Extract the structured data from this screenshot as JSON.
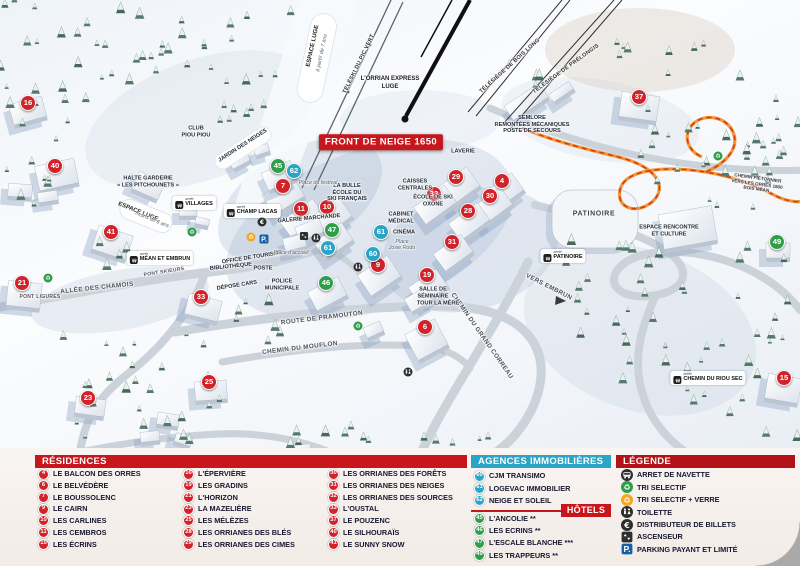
{
  "colors": {
    "red": "#c8161d",
    "darkred": "#b31218",
    "marker_red": "#d2232a",
    "green": "#2f9e49",
    "blue": "#2ba4c6",
    "parking_blue": "#1660a8",
    "path_orange": "#f08c1e"
  },
  "map": {
    "banner": "FRONT DE NEIGE 1650",
    "markers": [
      {
        "n": "16",
        "type": "res",
        "x": 28,
        "y": 103
      },
      {
        "n": "40",
        "type": "res",
        "x": 55,
        "y": 166
      },
      {
        "n": "41",
        "type": "res",
        "x": 111,
        "y": 232
      },
      {
        "n": "21",
        "type": "res",
        "x": 22,
        "y": 283
      },
      {
        "n": "33",
        "type": "res",
        "x": 201,
        "y": 297
      },
      {
        "n": "23",
        "type": "res",
        "x": 88,
        "y": 398
      },
      {
        "n": "25",
        "type": "res",
        "x": 209,
        "y": 382
      },
      {
        "n": "7",
        "type": "res",
        "x": 283,
        "y": 186
      },
      {
        "n": "11",
        "type": "res",
        "x": 301,
        "y": 209
      },
      {
        "n": "10",
        "type": "res",
        "x": 327,
        "y": 207
      },
      {
        "n": "9",
        "type": "res",
        "x": 378,
        "y": 265
      },
      {
        "n": "19",
        "type": "res",
        "x": 427,
        "y": 275
      },
      {
        "n": "6",
        "type": "res",
        "x": 425,
        "y": 327
      },
      {
        "n": "29",
        "type": "res",
        "x": 456,
        "y": 177
      },
      {
        "n": "4",
        "type": "res",
        "x": 502,
        "y": 181
      },
      {
        "n": "32",
        "type": "res",
        "x": 434,
        "y": 194
      },
      {
        "n": "30",
        "type": "res",
        "x": 490,
        "y": 196
      },
      {
        "n": "28",
        "type": "res",
        "x": 468,
        "y": 211
      },
      {
        "n": "31",
        "type": "res",
        "x": 452,
        "y": 242
      },
      {
        "n": "37",
        "type": "res",
        "x": 639,
        "y": 97
      },
      {
        "n": "15",
        "type": "res",
        "x": 784,
        "y": 378
      },
      {
        "n": "45",
        "type": "hotel",
        "x": 278,
        "y": 166
      },
      {
        "n": "47",
        "type": "hotel",
        "x": 332,
        "y": 230
      },
      {
        "n": "46",
        "type": "hotel",
        "x": 326,
        "y": 283
      },
      {
        "n": "49",
        "type": "hotel",
        "x": 777,
        "y": 242
      },
      {
        "n": "62",
        "type": "agence",
        "x": 294,
        "y": 171
      },
      {
        "n": "61",
        "type": "agence",
        "x": 328,
        "y": 248
      },
      {
        "n": "61",
        "type": "agence",
        "x": 381,
        "y": 232
      },
      {
        "n": "60",
        "type": "agence",
        "x": 373,
        "y": 254
      }
    ],
    "labels": [
      {
        "text": "L'ORRIAN EXPRESS",
        "x": 390,
        "y": 79,
        "rot": 0,
        "cls": "dk"
      },
      {
        "text": "LUGE",
        "x": 390,
        "y": 87,
        "rot": 0,
        "cls": "dk"
      },
      {
        "text": "ESPACE LUGE",
        "x": 313,
        "y": 46,
        "rot": -78,
        "cls": "dk"
      },
      {
        "text": "à partir de 7 ans",
        "x": 322,
        "y": 53,
        "rot": -78,
        "cls": "it"
      },
      {
        "text": "TÉLÉSKI DU PIC VERT",
        "x": 359,
        "y": 64,
        "rot": -64,
        "cls": "lift"
      },
      {
        "text": "TÉLÉSIÈGE DE BOIS LONG",
        "x": 510,
        "y": 66,
        "rot": -42,
        "cls": "lift"
      },
      {
        "text": "TÉLÉSIÈGE DE PRÉLONGIS",
        "x": 566,
        "y": 69,
        "rot": -36,
        "cls": "lift"
      },
      {
        "lines": [
          "SEMLORE",
          "REMONTÉES MÉCANIQUES",
          "POSTE DE SECOURS"
        ],
        "x": 532,
        "y": 125,
        "rot": 0,
        "cls": "bld"
      },
      {
        "text": "LAVERIE",
        "x": 463,
        "y": 152,
        "rot": 0,
        "cls": "bld"
      },
      {
        "lines": [
          "CAISSES",
          "CENTRALES"
        ],
        "x": 415,
        "y": 185,
        "rot": 0,
        "cls": "bld"
      },
      {
        "lines": [
          "LA BULLE",
          "ÉCOLE DU",
          "SKI FRANÇAIS"
        ],
        "x": 347,
        "y": 193,
        "rot": 0,
        "cls": "bld"
      },
      {
        "text": "Place du festival",
        "x": 318,
        "y": 183,
        "rot": 0,
        "cls": "it"
      },
      {
        "text": "GALERIE MARCHANDE",
        "x": 309,
        "y": 219,
        "rot": -5,
        "cls": "bld"
      },
      {
        "lines": [
          "ÉCOLE DE SKI",
          "OXONE"
        ],
        "x": 433,
        "y": 201,
        "rot": 0,
        "cls": "bld"
      },
      {
        "lines": [
          "CABINET",
          "MÉDICAL"
        ],
        "x": 401,
        "y": 218,
        "rot": 0,
        "cls": "bld"
      },
      {
        "text": "CINÉMA",
        "x": 404,
        "y": 233,
        "rot": 0,
        "cls": "bld"
      },
      {
        "lines": [
          "Place",
          "Josie Rodo"
        ],
        "x": 402,
        "y": 245,
        "rot": 0,
        "cls": "it"
      },
      {
        "lines": [
          "CLUB",
          "PIOU PIOU"
        ],
        "x": 196,
        "y": 132,
        "rot": 0,
        "cls": "bld"
      },
      {
        "text": "JARDIN DES NEIGES",
        "x": 243,
        "y": 146,
        "rot": -33,
        "cls": "bld"
      },
      {
        "lines": [
          "HALTE GARDERIE",
          "« LES PITCHOUNETS »"
        ],
        "x": 148,
        "y": 182,
        "rot": 0,
        "cls": "bld"
      },
      {
        "text": "ESPACE LUGE",
        "x": 138,
        "y": 212,
        "rot": 22,
        "cls": "dk"
      },
      {
        "text": "moins de 6 ans",
        "x": 152,
        "y": 220,
        "rot": 22,
        "cls": "it"
      },
      {
        "text": "PATINOIRE",
        "x": 594,
        "y": 214,
        "rot": 0,
        "cls": "bldlg"
      },
      {
        "lines": [
          "ESPACE RENCONTRE",
          "ET CULTURE"
        ],
        "x": 669,
        "y": 231,
        "rot": 0,
        "cls": "bld"
      },
      {
        "text": "VERS EMBRUN",
        "x": 549,
        "y": 287,
        "rot": 27,
        "cls": "road"
      },
      {
        "text": "ALLÉE DES CHAMOIS",
        "x": 97,
        "y": 288,
        "rot": -6,
        "cls": "road"
      },
      {
        "text": "PONT LIGURES",
        "x": 40,
        "y": 297,
        "rot": 0,
        "cls": "roadsm"
      },
      {
        "text": "PONT SKIEURS",
        "x": 164,
        "y": 272,
        "rot": -9,
        "cls": "roadsm"
      },
      {
        "text": "BIBLIOTHÈQUE",
        "x": 231,
        "y": 267,
        "rot": -6,
        "cls": "bld"
      },
      {
        "text": "OFFICE DE TOURISME",
        "x": 252,
        "y": 258,
        "rot": -9,
        "cls": "bld"
      },
      {
        "text": "POSTE",
        "x": 263,
        "y": 269,
        "rot": 0,
        "cls": "bld"
      },
      {
        "text": "DÉPOSE CARS",
        "x": 237,
        "y": 286,
        "rot": -9,
        "cls": "bld"
      },
      {
        "lines": [
          "POLICE",
          "MUNICIPALE"
        ],
        "x": 282,
        "y": 285,
        "rot": 0,
        "cls": "bld"
      },
      {
        "text": "Place d'accueil",
        "x": 291,
        "y": 253,
        "rot": 0,
        "cls": "it"
      },
      {
        "text": "ROUTE DE PRAMOUTON",
        "x": 322,
        "y": 318,
        "rot": -7,
        "cls": "road"
      },
      {
        "text": "CHEMIN DU MOUFLON",
        "x": 300,
        "y": 348,
        "rot": -7,
        "cls": "road"
      },
      {
        "text": "CHEMIN DU GRAND CORREAU",
        "x": 482,
        "y": 336,
        "rot": 55,
        "cls": "road"
      },
      {
        "lines": [
          "SALLE DE",
          "SÉMINAIRE"
        ],
        "x": 433,
        "y": 293,
        "rot": 0,
        "cls": "bld"
      },
      {
        "text": "TOUR LA MÈRE",
        "x": 438,
        "y": 304,
        "rot": 0,
        "cls": "bld"
      },
      {
        "lines": [
          "CHEMIN PIÉTONNIER",
          "VERS LES ORRES 1800",
          "BOIS MÉAN"
        ],
        "x": 757,
        "y": 184,
        "rot": 8,
        "cls": "tiny"
      }
    ],
    "stops": [
      {
        "label": "VILLAGES",
        "x": 194,
        "y": 203
      },
      {
        "label": "CHAMP LACAS",
        "x": 252,
        "y": 211
      },
      {
        "label": "MÉAN ET EMBRUN",
        "x": 160,
        "y": 258
      },
      {
        "label": "PATINOIRE",
        "x": 563,
        "y": 256
      },
      {
        "label": "CHEMIN DU RIOU SEC",
        "x": 708,
        "y": 378
      }
    ],
    "icons": [
      {
        "t": "recycle-green",
        "x": 48,
        "y": 278
      },
      {
        "t": "recycle-green",
        "x": 192,
        "y": 232
      },
      {
        "t": "recycle-green",
        "x": 358,
        "y": 326
      },
      {
        "t": "recycle-green",
        "x": 718,
        "y": 156
      },
      {
        "t": "recycle-orange",
        "x": 251,
        "y": 237
      },
      {
        "t": "parking",
        "x": 264,
        "y": 239
      },
      {
        "t": "elevator",
        "x": 304,
        "y": 236
      },
      {
        "t": "toilet",
        "x": 316,
        "y": 238
      },
      {
        "t": "toilet",
        "x": 358,
        "y": 267
      },
      {
        "t": "toilet",
        "x": 408,
        "y": 372
      },
      {
        "t": "atm",
        "x": 262,
        "y": 222
      }
    ]
  },
  "legend": {
    "residences": {
      "title": "RÉSIDENCES",
      "items": [
        {
          "n": "4",
          "label": "LE BALCON DES ORRES"
        },
        {
          "n": "6",
          "label": "LE BELVÉDÈRE"
        },
        {
          "n": "7",
          "label": "LE BOUSSOLENC"
        },
        {
          "n": "9",
          "label": "LE CAIRN"
        },
        {
          "n": "10",
          "label": "LES CARLINES"
        },
        {
          "n": "11",
          "label": "LES CEMBROS"
        },
        {
          "n": "15",
          "label": "LES ÉCRINS"
        },
        {
          "n": "16",
          "label": "L'ÉPERVIÈRE"
        },
        {
          "n": "19",
          "label": "LES GRADINS"
        },
        {
          "n": "21",
          "label": "L'HORIZON"
        },
        {
          "n": "23",
          "label": "LA MAZELIÈRE"
        },
        {
          "n": "25",
          "label": "LES MÉLÈZES"
        },
        {
          "n": "28",
          "label": "LES ORRIANES DES BLÉS"
        },
        {
          "n": "29",
          "label": "LES ORRIANES DES CIMES"
        },
        {
          "n": "30",
          "label": "LES ORRIANES DES FORÊTS"
        },
        {
          "n": "31",
          "label": "LES ORRIANES DES NEIGES"
        },
        {
          "n": "32",
          "label": "LES ORRIANES DES SOURCES"
        },
        {
          "n": "33",
          "label": "L'OUSTAL"
        },
        {
          "n": "37",
          "label": "LE POUZENC"
        },
        {
          "n": "40",
          "label": "LE SILHOURAÏS"
        },
        {
          "n": "41",
          "label": "LE SUNNY SNOW"
        }
      ]
    },
    "agences": {
      "title": "AGENCES IMMOBILIÈRES",
      "items": [
        {
          "n": "60",
          "label": "CJM TRANSIMO"
        },
        {
          "n": "61",
          "label": "LOGEVAC IMMOBILIER"
        },
        {
          "n": "62",
          "label": "NEIGE ET SOLEIL"
        }
      ]
    },
    "hotels": {
      "title": "HÔTELS",
      "items": [
        {
          "n": "45",
          "label": "L'ANCOLIE **"
        },
        {
          "n": "46",
          "label": "LES ECRINS **"
        },
        {
          "n": "47",
          "label": "L'ESCALE BLANCHE ***"
        },
        {
          "n": "49",
          "label": "LES TRAPPEURS **"
        }
      ]
    },
    "legende": {
      "title": "LÉGENDE",
      "items": [
        {
          "icon": "bus",
          "label": "ARRET DE NAVETTE"
        },
        {
          "icon": "recycle-green",
          "label": "TRI SELECTIF"
        },
        {
          "icon": "recycle-orange",
          "label": "TRI SELECTIF + VERRE"
        },
        {
          "icon": "toilet",
          "label": "TOILETTE"
        },
        {
          "icon": "atm",
          "label": "DISTRIBUTEUR DE BILLETS"
        },
        {
          "icon": "elevator",
          "label": "ASCENSEUR"
        },
        {
          "icon": "parking",
          "label": "PARKING PAYANT ET LIMITÉ"
        }
      ]
    }
  }
}
